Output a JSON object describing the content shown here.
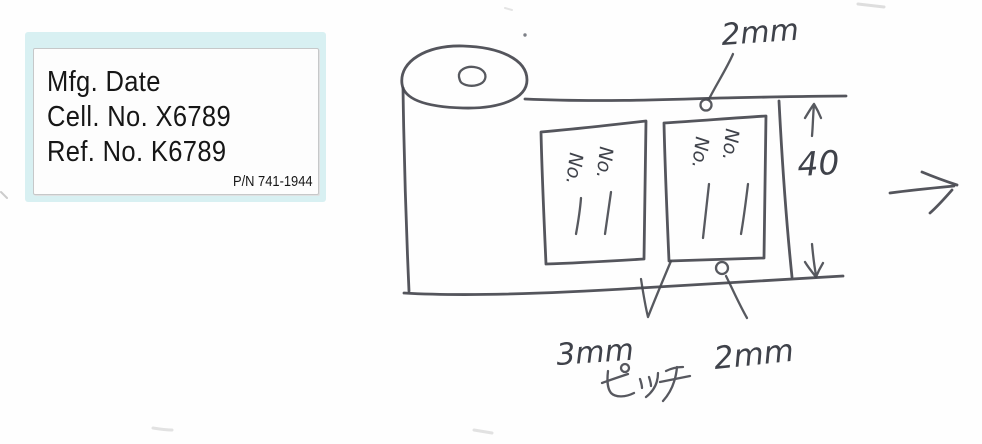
{
  "colors": {
    "ink": "#45474e",
    "sticker_background": "#d8f0f2",
    "label_card_background": "#fdfdfd",
    "label_text": "#161616"
  },
  "product_label": {
    "lines": [
      "Mfg. Date",
      "Cell. No. X6789",
      "Ref. No. K6789"
    ],
    "part_number": "P/N 741-1944"
  },
  "sketch": {
    "top_gap_dimension": "2mm",
    "tape_width_dimension": "40",
    "pitch_dimension": "3mm",
    "pitch_unit_kana": "ピッチ",
    "bottom_gap_dimension": "2mm",
    "label_field_text": "No."
  }
}
